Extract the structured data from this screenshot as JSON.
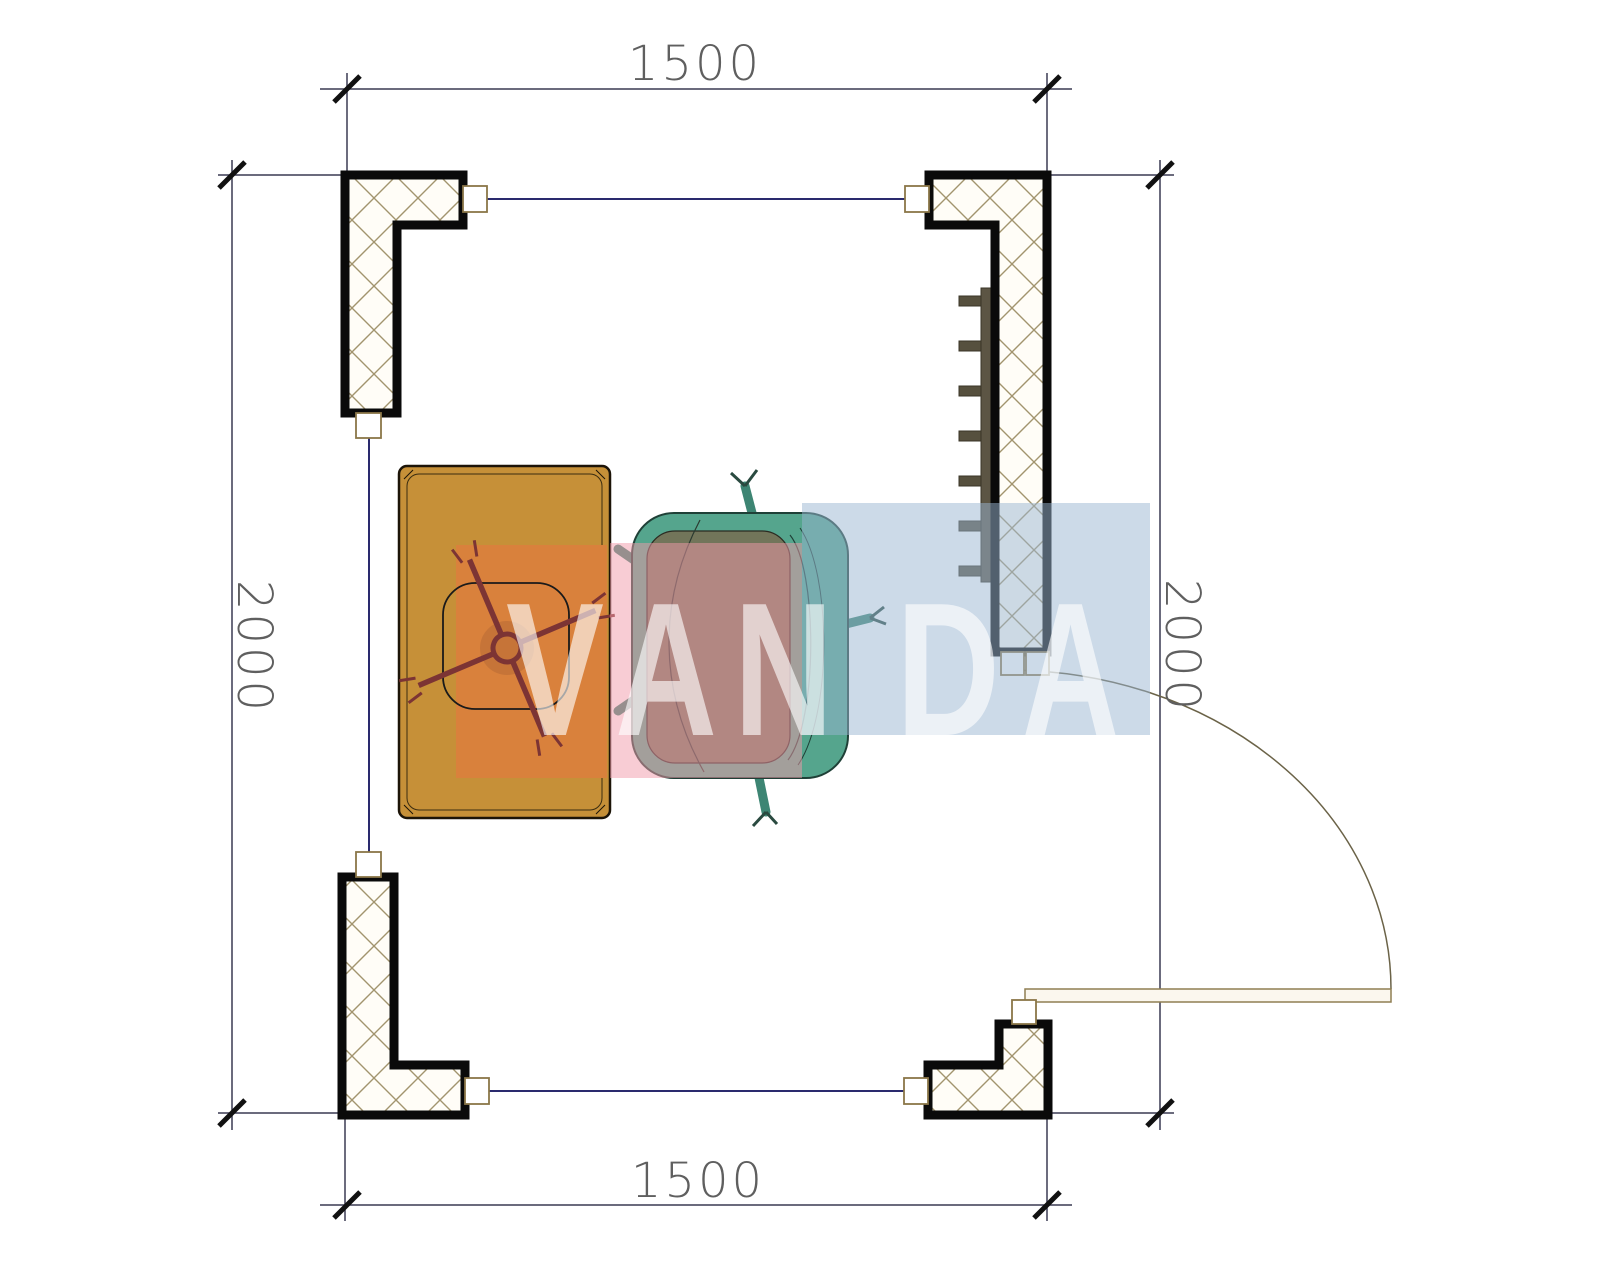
{
  "page": {
    "type": "architectural-floor-plan",
    "background": "#ffffff"
  },
  "dimensions": {
    "top": {
      "value": "1500"
    },
    "bottom": {
      "value": "1500"
    },
    "left": {
      "value": "2000"
    },
    "right": {
      "value": "2000"
    }
  },
  "watermark": {
    "text": "VANDA",
    "letters": [
      "V",
      "A",
      "N",
      "D",
      "A"
    ],
    "letter_color": "rgba(255,255,255,0.62)",
    "block_colors": {
      "orange": "#d9813c",
      "pink": "#f8ccd4",
      "blue": "#ccd9e8"
    }
  },
  "colors": {
    "desk": "#c69038",
    "desk_accent_block": "#d9813c",
    "armchair": "#55a58d",
    "armchair_seat": "#72755a",
    "office_chair_base": "#7c3434",
    "radiator": "#5c5544",
    "wall_hatch": "#a2946e",
    "window_line": "#2a2a6e",
    "dimension_line": "#3a3a52",
    "dimension_text": "#5f5f5f",
    "door_line": "#8f7f52"
  }
}
